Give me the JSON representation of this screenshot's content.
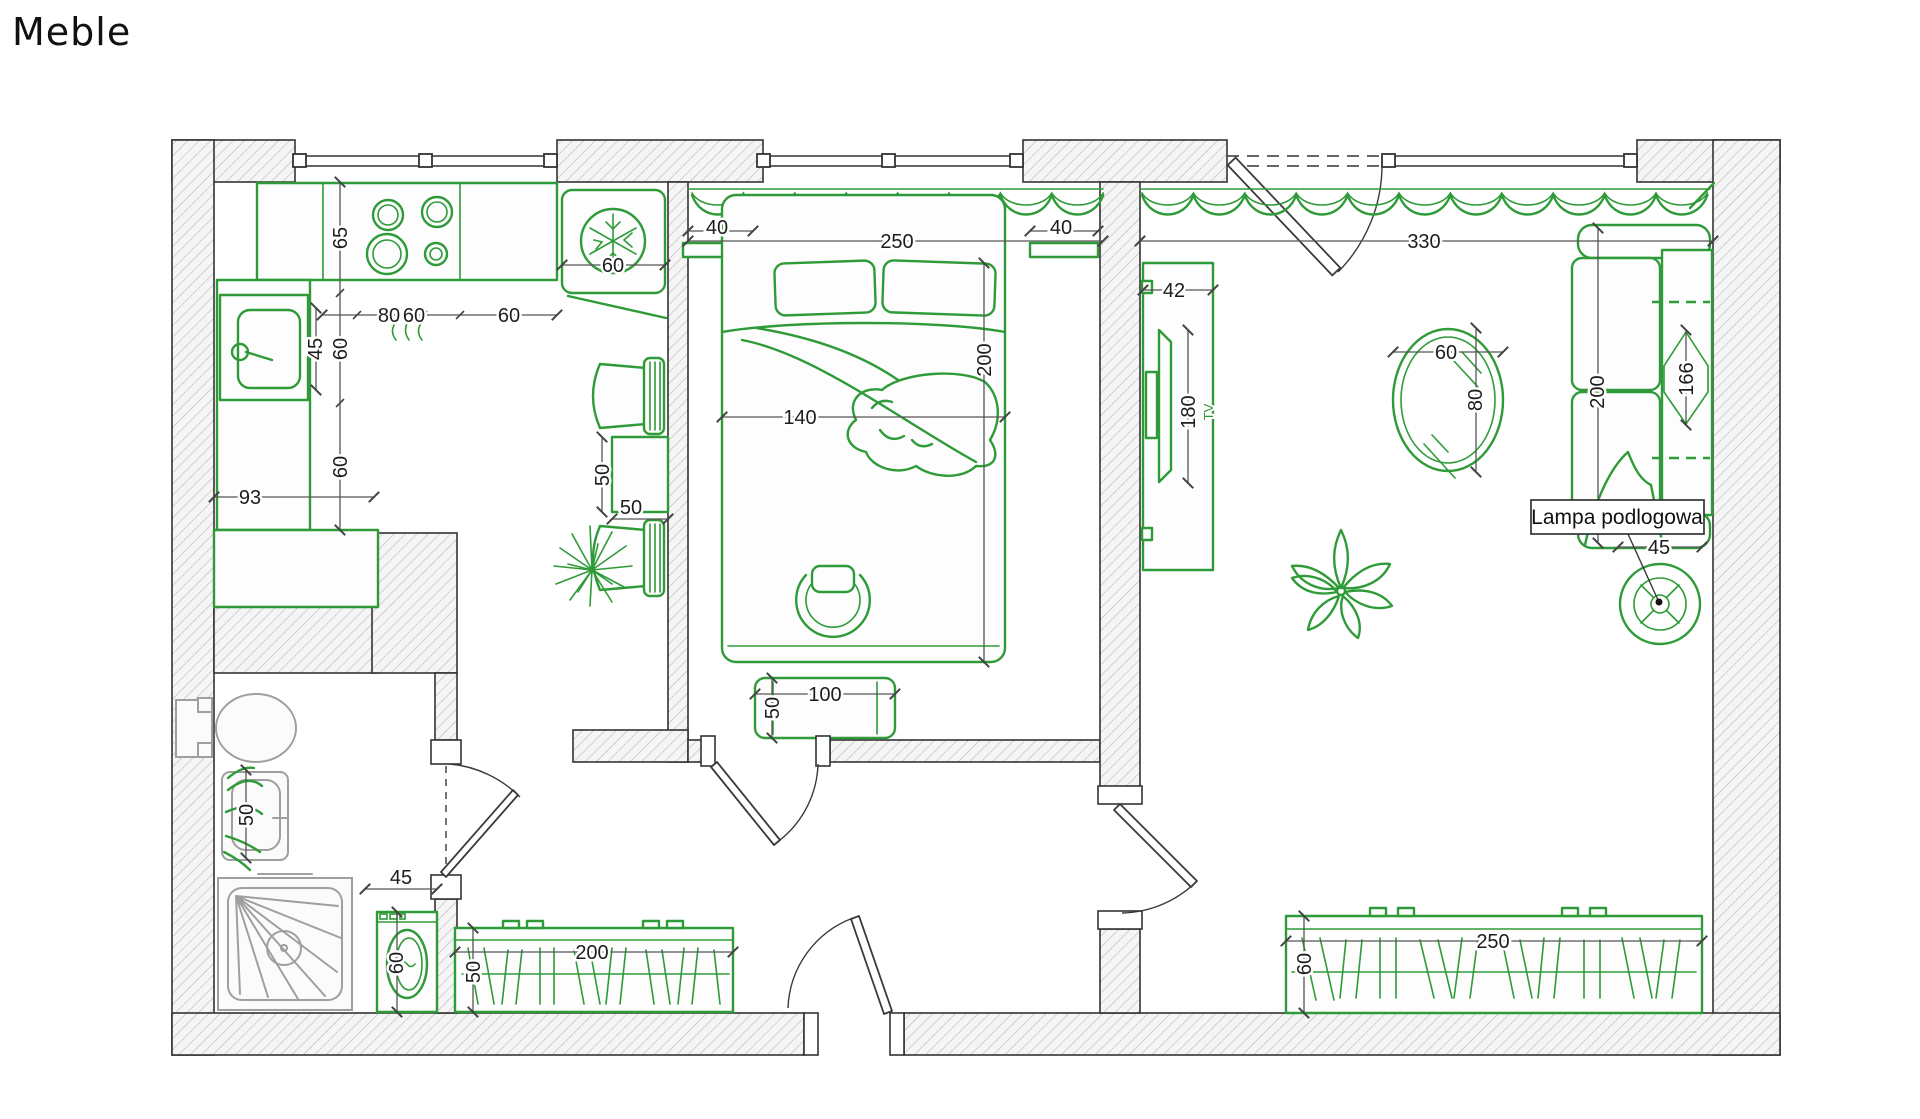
{
  "title": "Meble",
  "floor_lamp_annotation": "Lampa podlogowa",
  "colors": {
    "furniture_green": "#2e9b38",
    "wall_outline": "#333333",
    "fixture_gray": "#9f9f9f",
    "dimension_text": "#1d1d1d",
    "background": "#ffffff"
  },
  "icons": {
    "fridge": "snowflake-icon",
    "lamp": "concentric-circles-icon",
    "plants": "leaf-cluster-icon"
  },
  "dims": {
    "kitchen_counter_depth": "65",
    "kitchen_sink_width": "45",
    "kitchen_left_depth_upper": "60",
    "kitchen_left_depth_lower": "60",
    "kitchen_cabinet_width": "93",
    "kitchen_chain_80": "80",
    "kitchen_chain_60a": "60",
    "kitchen_chain_60b": "60",
    "fridge_width": "60",
    "kitchen_table_depth": "50",
    "kitchen_table_width": "50",
    "nightstand_left_width": "40",
    "bedroom_window_width": "250",
    "nightstand_right_width": "40",
    "bed_length": "200",
    "bed_width": "140",
    "bench_width": "100",
    "bench_depth": "50",
    "living_window_width": "330",
    "tv_unit_depth": "42",
    "tv_unit_length": "180",
    "tv_label": "TV",
    "mirror_width": "60",
    "mirror_height": "80",
    "sofa_length": "200",
    "sofa_width": "166",
    "lamp_diameter": "45",
    "living_wardrobe_width": "250",
    "living_wardrobe_depth": "60",
    "bath_sink_width": "50",
    "washer_width": "45",
    "washer_depth": "60",
    "hall_wardrobe_width": "200",
    "hall_wardrobe_depth": "50"
  }
}
